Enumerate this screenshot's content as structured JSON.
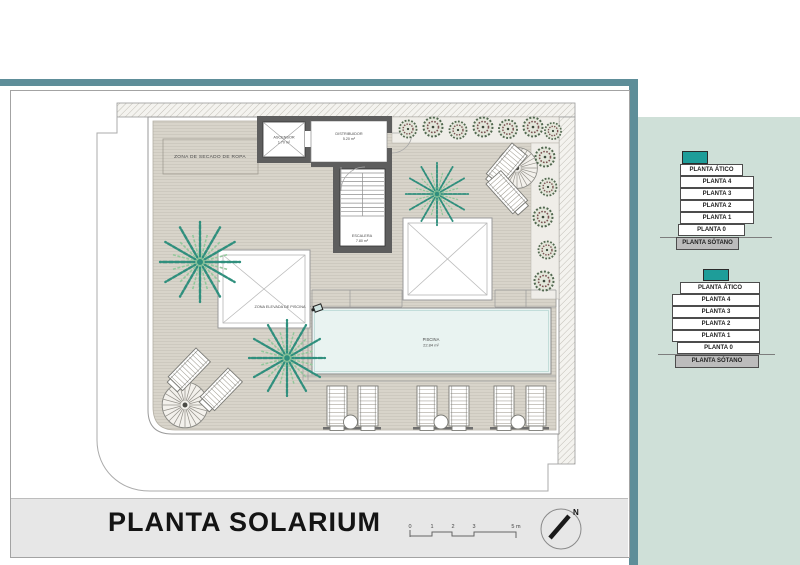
{
  "plan": {
    "zona_secado": "ZONA DE SECADO DE ROPA",
    "ascensor": {
      "name": "ASCENSOR",
      "area": "1.70 m²"
    },
    "distribuidor": {
      "name": "DISTRIBUIDOR",
      "area": "5.20 m²"
    },
    "escalera": {
      "name": "ESCALERA",
      "area": "7.80 m²"
    },
    "piscina": {
      "name": "PISCINA",
      "area": "22.84 m²"
    },
    "zona_elevada": "ZONA ELEVADA DE PISCINA"
  },
  "stacks": {
    "top": {
      "floors": [
        "PLANTA ÁTICO",
        "PLANTA 4",
        "PLANTA 3",
        "PLANTA 2",
        "PLANTA 1",
        "PLANTA 0",
        "PLANTA SÓTANO"
      ]
    },
    "bottom": {
      "floors": [
        "PLANTA ÁTICO",
        "PLANTA 4",
        "PLANTA 3",
        "PLANTA 2",
        "PLANTA 1",
        "PLANTA 0",
        "PLANTA SÓTANO"
      ]
    }
  },
  "footer": {
    "title": "PLANTA SOLARIUM",
    "scale_ticks": [
      "0",
      "1",
      "2",
      "3",
      "5 m"
    ],
    "north": "N"
  },
  "colors": {
    "bar_teal": "#5e8e99",
    "panel_bg": "#cfe0d8",
    "accent_teal": "#1e9d99",
    "deck": "#d8d4ca",
    "pool": "#e9f3f1",
    "footer_bg": "#e7e7e7"
  }
}
